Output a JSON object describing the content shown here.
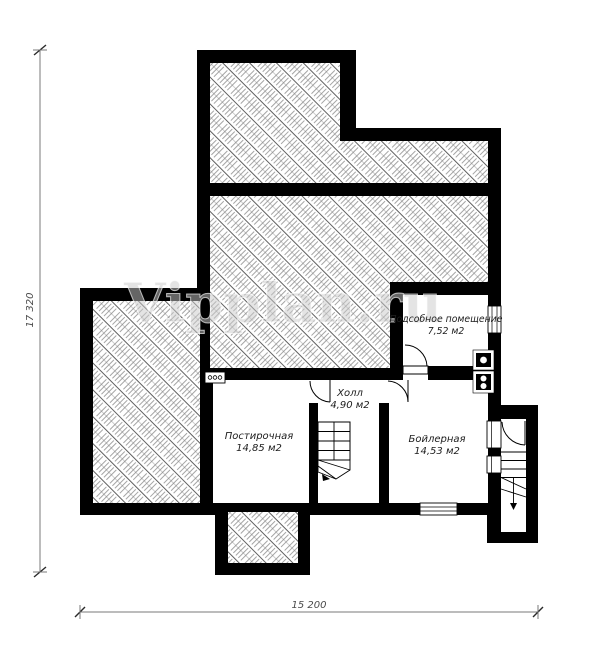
{
  "plan": {
    "type": "basement-floor-plan",
    "watermark": {
      "text": "Vipplan.ru"
    },
    "rooms": {
      "utility": {
        "name": "Подсобное помещение",
        "area": "7,52 м2"
      },
      "hall": {
        "name": "Холл",
        "area": "4,90 м2"
      },
      "laundry": {
        "name": "Постирочная",
        "area": "14,85 м2"
      },
      "boiler": {
        "name": "Бойлерная",
        "area": "14,53 м2"
      }
    },
    "dimensions": {
      "total_width": "15 200",
      "total_height": "17 320"
    },
    "colors": {
      "wall": "#000000",
      "hatch_line": "#6a6a6a",
      "dimension_line": "#7a7a7a",
      "background": "#ffffff"
    }
  }
}
